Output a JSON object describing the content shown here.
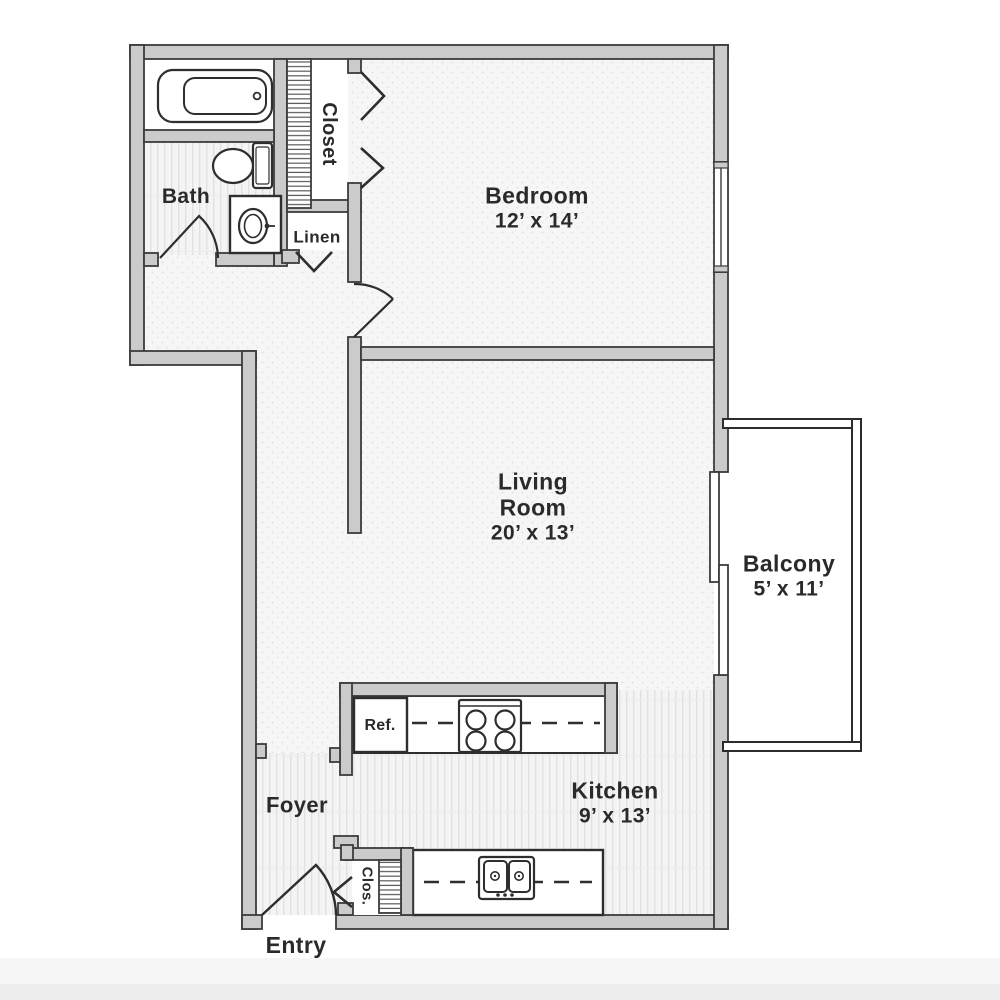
{
  "floorplan": {
    "rooms": {
      "bedroom": {
        "name": "Bedroom",
        "dimensions": "12’ x 14’"
      },
      "living_room": {
        "name_line1": "Living",
        "name_line2": "Room",
        "dimensions": "20’ x 13’"
      },
      "kitchen": {
        "name": "Kitchen",
        "dimensions": "9’ x 13’"
      },
      "balcony": {
        "name": "Balcony",
        "dimensions": "5’ x 11’"
      },
      "bath": {
        "name": "Bath"
      },
      "closet": {
        "name": "Closet"
      },
      "linen": {
        "name": "Linen"
      },
      "foyer": {
        "name": "Foyer"
      },
      "entry": {
        "name": "Entry"
      },
      "small_closet": {
        "name": "Clos."
      },
      "refrigerator": {
        "name": "Ref."
      }
    },
    "colors": {
      "wall_fill": "#cbcbcb",
      "wall_outline": "#3c3c3c",
      "floor_base": "#f6f6f6",
      "floor_pattern": "#e2e2e2",
      "fixture_outline": "#2e2e2e",
      "label_text": "#2a2a2a"
    }
  }
}
